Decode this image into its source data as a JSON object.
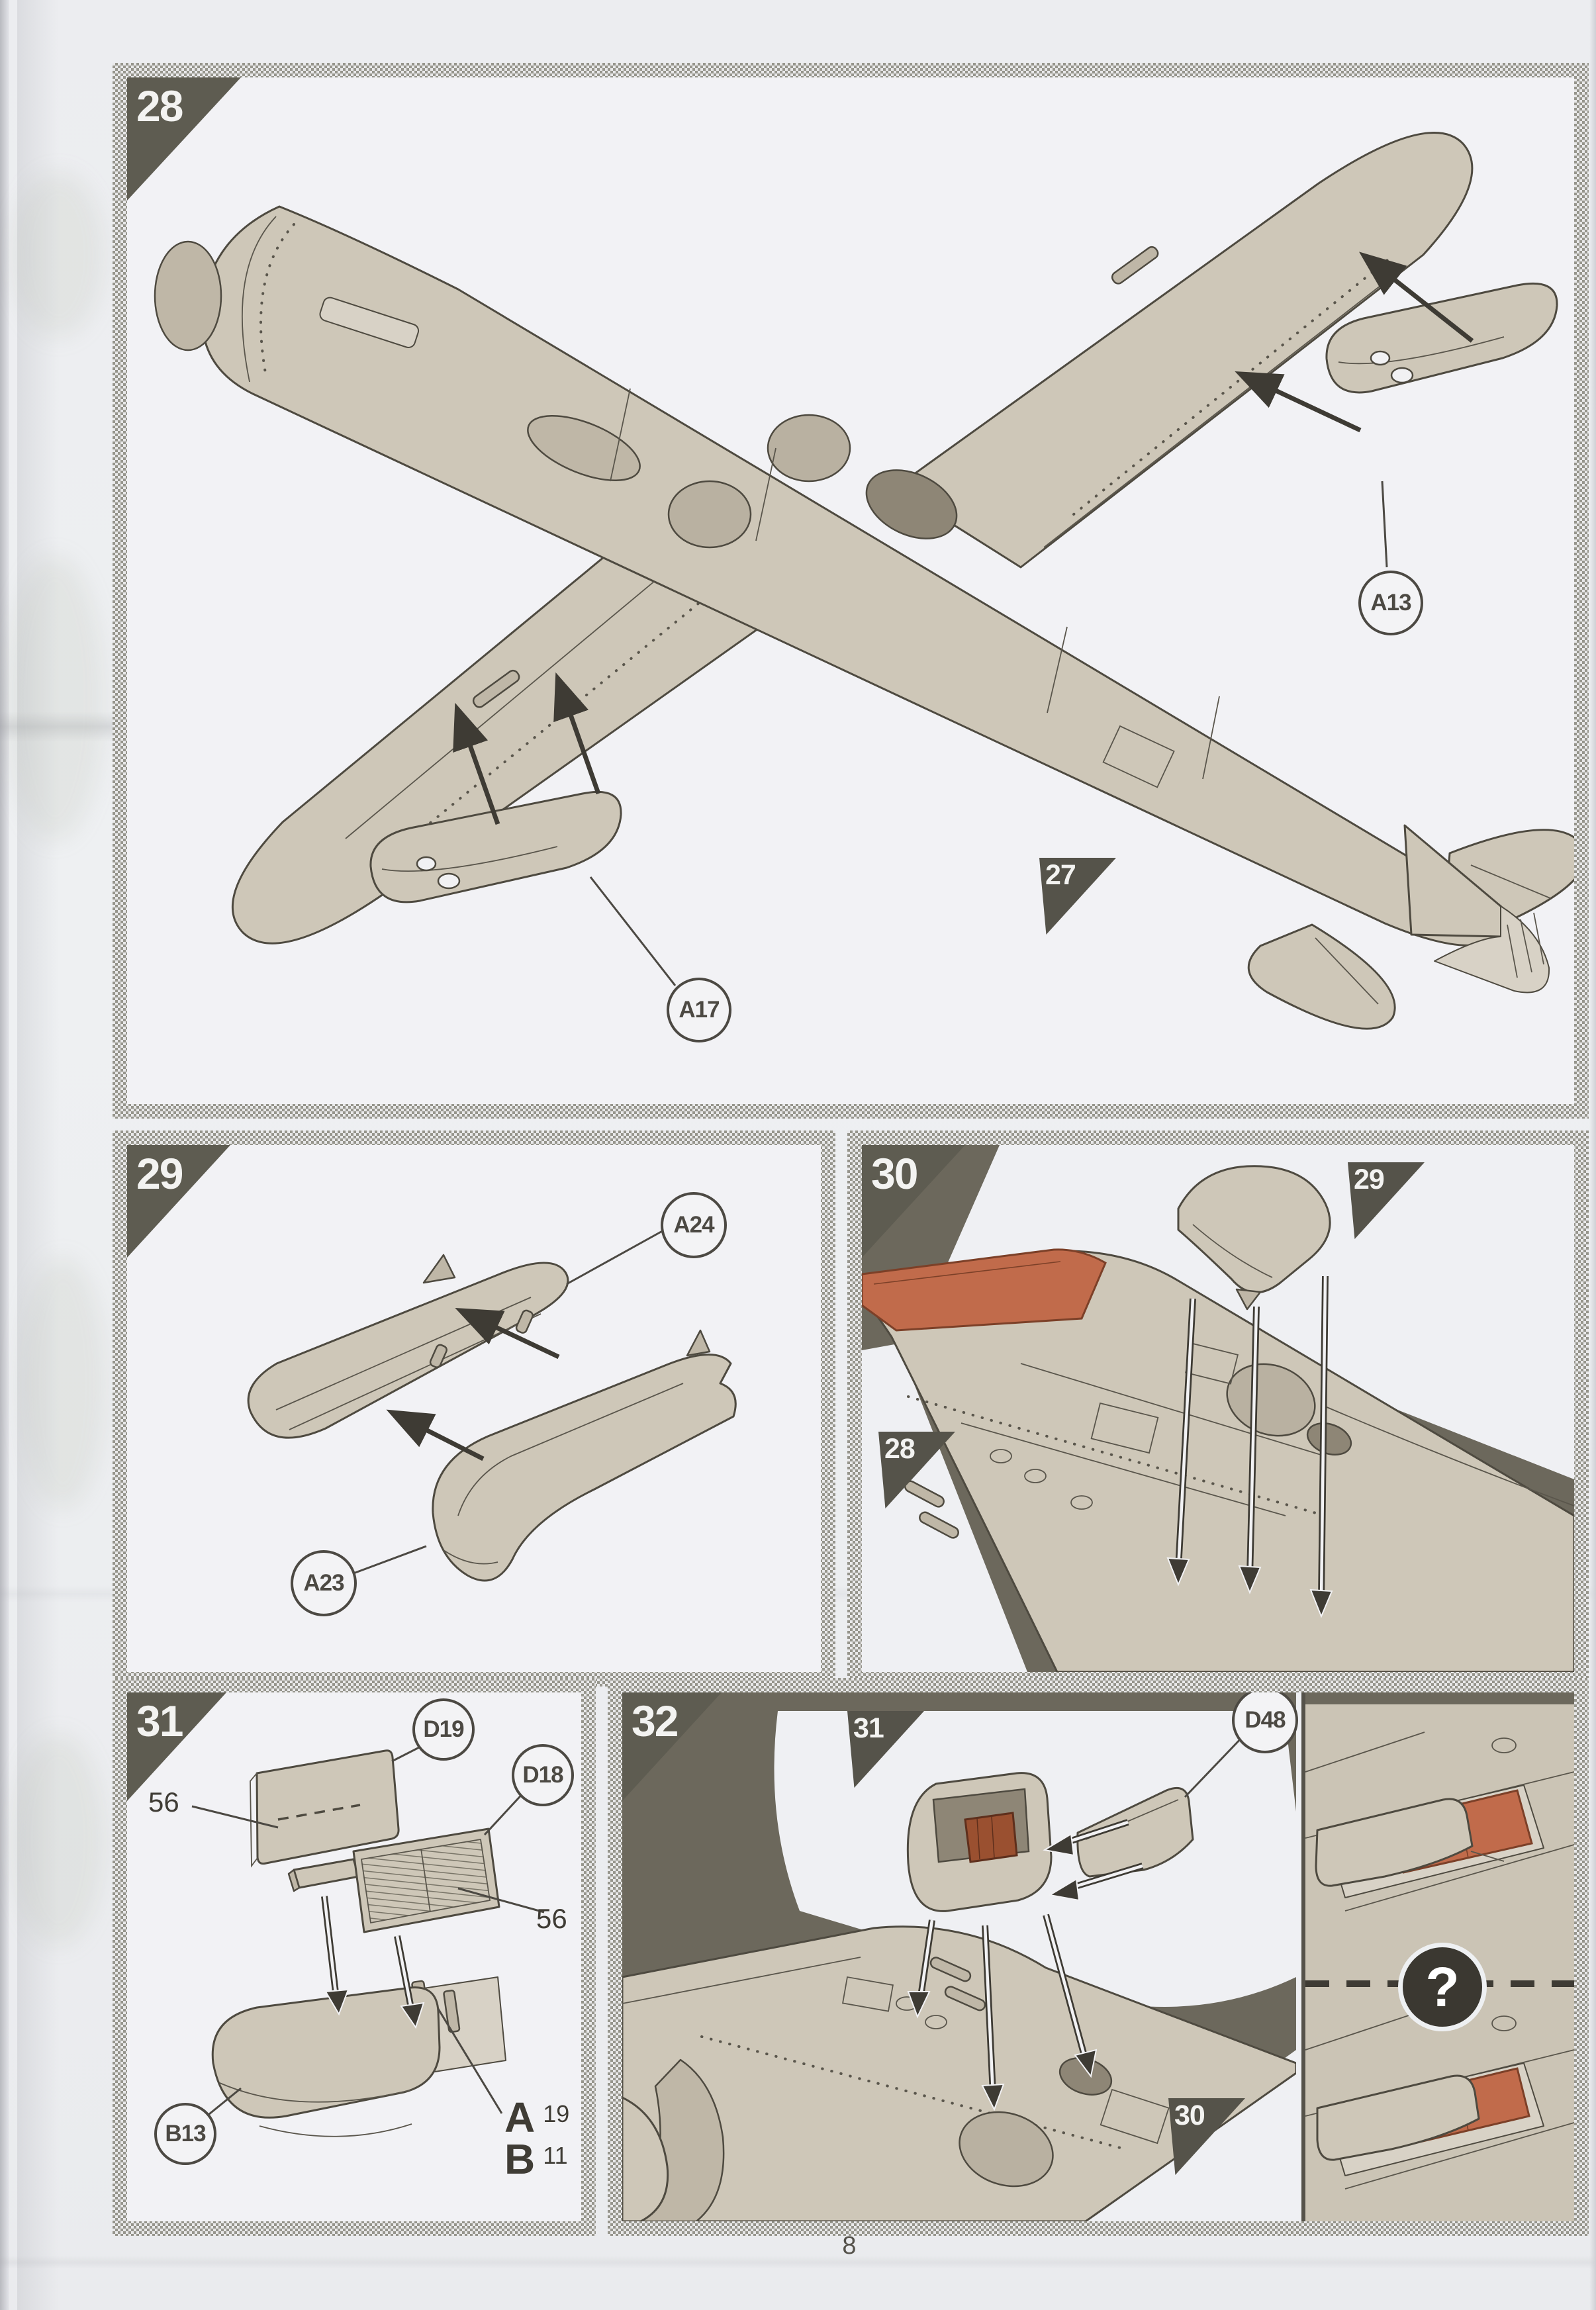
{
  "footer": {
    "page_number": "8"
  },
  "colors": {
    "paper": "#ecedf0",
    "panel_light": "#f2f2f5",
    "panel_dark": "#6c685c",
    "marker_dark": "#5e5c51",
    "line": "#4c4943",
    "part_fill": "#cec7b8",
    "walkway_red": "#c16b4b",
    "radiator_brown": "#9a5030"
  },
  "panels": {
    "p28": {
      "step": "28",
      "ref_step": "27",
      "callout_a13": "A13",
      "callout_a17": "A17"
    },
    "p29": {
      "step": "29",
      "callout_a24": "A24",
      "callout_a23": "A23"
    },
    "p30": {
      "step": "30",
      "ref_step_top": "29",
      "ref_step_bottom": "28"
    },
    "p31": {
      "step": "31",
      "callout_d19": "D19",
      "callout_d18": "D18",
      "callout_b13": "B13",
      "decal_left": "56",
      "decal_right": "56",
      "variant_a_letter": "A",
      "variant_a_count": "19",
      "variant_b_letter": "B",
      "variant_b_count": "11"
    },
    "p32": {
      "step": "32",
      "ref_step_inner": "31",
      "ref_step_bottom": "30",
      "callout_d48": "D48",
      "unknown_mark": "?"
    }
  }
}
